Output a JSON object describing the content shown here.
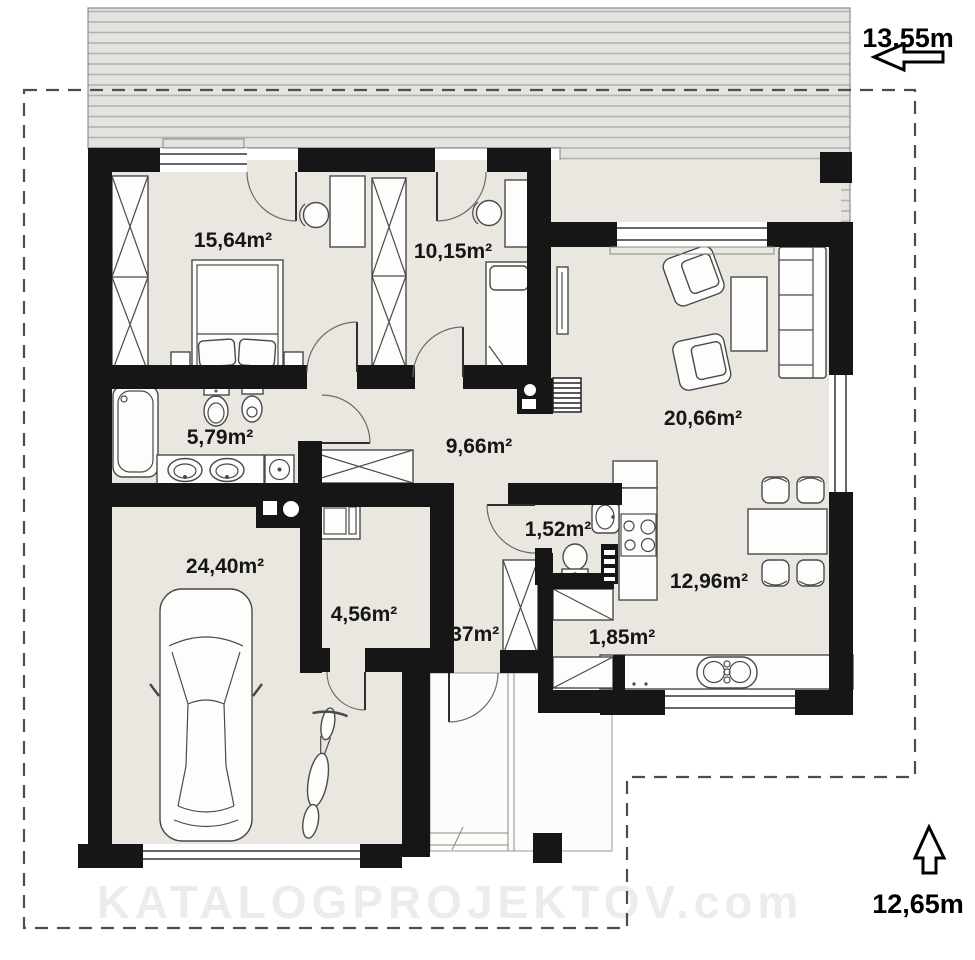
{
  "plan": {
    "watermark": "KATALOGPROJEKTOV.com",
    "dimensions": {
      "top": {
        "label": "13,55m"
      },
      "side": {
        "label": "12,65m"
      }
    },
    "rooms": {
      "bedroom1": {
        "label": "15,64m²"
      },
      "bedroom2": {
        "label": "10,15m²"
      },
      "bathroom": {
        "label": "5,79m²"
      },
      "hall": {
        "label": "9,66m²"
      },
      "living": {
        "label": "20,66m²"
      },
      "wc": {
        "label": "1,52m²"
      },
      "kitchen": {
        "label": "12,96m²"
      },
      "garage": {
        "label": "24,40m²"
      },
      "utility": {
        "label": "4,56m²"
      },
      "entry": {
        "label": "3,37m²"
      },
      "pantry": {
        "label": "1,85m²"
      }
    },
    "colors": {
      "wall": "#161616",
      "floor": "#eae7e1",
      "terrace": "#e4e3e0",
      "terrace-line": "#b3b2af",
      "boundary": "#4d4d4d"
    }
  }
}
